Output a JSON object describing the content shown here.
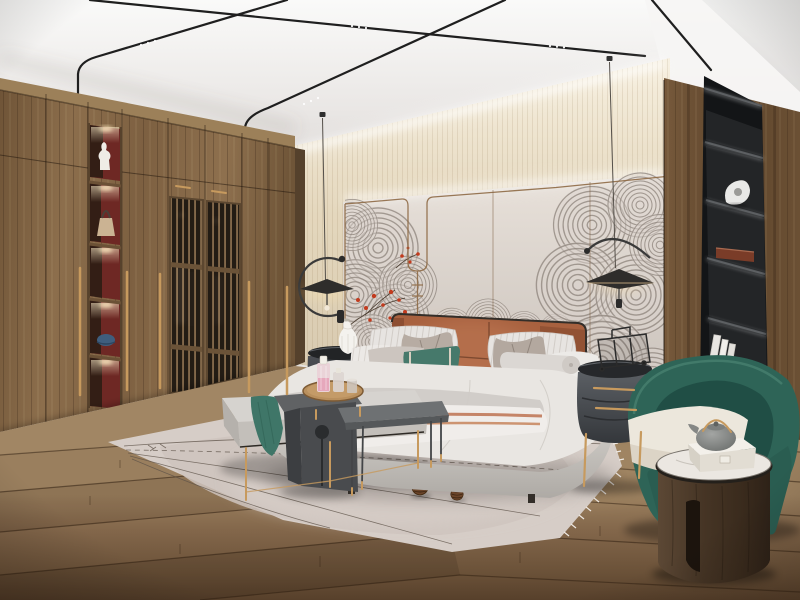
{
  "scene": {
    "title": "Modern Chinese style bedroom interior 3D render",
    "image_type": "3d-interior-render",
    "room": "bedroom",
    "objects": [
      "ceiling-track-lights",
      "pendant-lamp-left",
      "pendant-lamp-right",
      "wardrobe",
      "wardrobe-lattice-doors",
      "display-niches",
      "white-vase",
      "handbag",
      "blue-cap",
      "wall-mural-waves",
      "plum-blossoms",
      "bed",
      "leather-headboard",
      "pillows",
      "table-lamp-vase",
      "nightstand-left",
      "nightstand-right",
      "wire-luggage-decor",
      "bed-bench",
      "teal-throw",
      "waterfall-side-table",
      "serving-tray-with-bottles",
      "metal-side-table",
      "area-rug",
      "pinecones",
      "armchair-green",
      "round-wood-side-table",
      "teapot",
      "gift-box",
      "built-in-black-shelves",
      "books",
      "sculpture",
      "wood-floor"
    ],
    "palette": {
      "ceiling": "#eceae8",
      "wall_band": "#e6d9c2",
      "wall_panel": "#ddd6cf",
      "trim_bronze": "#8f6b46",
      "mural_ink": "#8a8078",
      "blossom_red": "#c23b1e",
      "wardrobe_wood": "#85684a",
      "niche_red": "#6e2824",
      "brass": "#c79a5e",
      "floor_wood": "#7a5f40",
      "rug": "#d6cdc7",
      "bed_linen": "#e9e6e2",
      "headboard_terracotta": "#a8613f",
      "blanket_teal": "#3f7668",
      "pillow_teal": "#46796b",
      "nightstand_charcoal": "#44474c",
      "armchair_green": "#2e6457",
      "side_table_walnut": "#46352a",
      "shelf_black": "#131517"
    }
  }
}
